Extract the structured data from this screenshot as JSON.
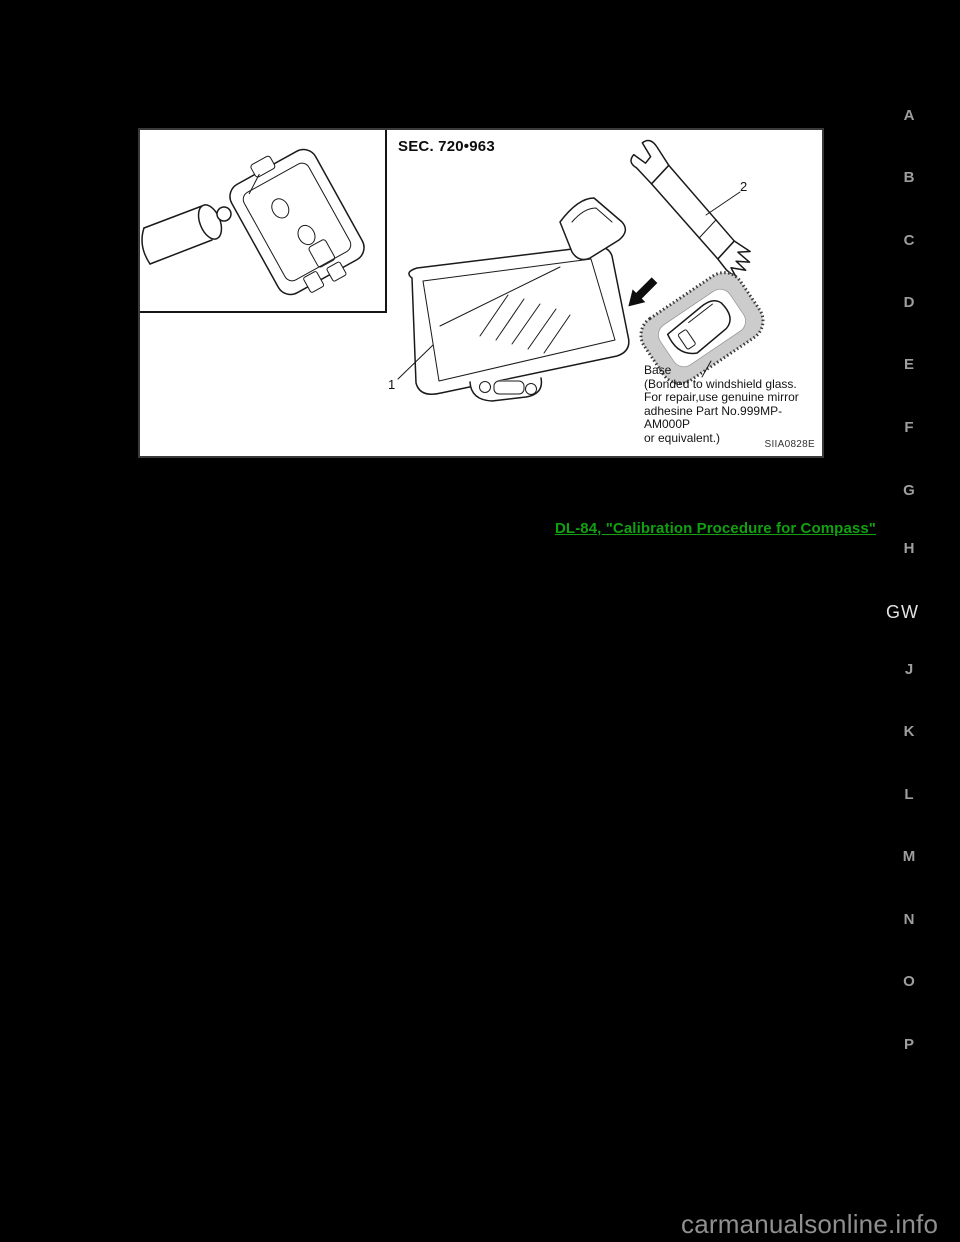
{
  "page": {
    "background": "#000000"
  },
  "diagram": {
    "sec_label": "SEC. 720•963",
    "callout_1": "1",
    "callout_2": "2",
    "base_note_lines": [
      "Base",
      "(Bonded to windshield glass.",
      "For repair,use genuine mirror",
      "adhesine Part No.999MP-AM000P",
      "or equivalent.)"
    ],
    "figure_code": "SIIA0828E"
  },
  "link": {
    "text": "DL-84, \"Calibration Procedure for Compass\""
  },
  "colors": {
    "link_green": "#12A012",
    "tab_gray": "#9e9e9e",
    "current_section_white": "#e2e2e2"
  },
  "section_tabs": {
    "current": "GW",
    "letters": [
      {
        "label": "A",
        "y": 115
      },
      {
        "label": "B",
        "y": 177
      },
      {
        "label": "C",
        "y": 240
      },
      {
        "label": "D",
        "y": 302
      },
      {
        "label": "E",
        "y": 364
      },
      {
        "label": "F",
        "y": 427
      },
      {
        "label": "G",
        "y": 490
      },
      {
        "label": "H",
        "y": 548
      },
      {
        "label": "J",
        "y": 669
      },
      {
        "label": "K",
        "y": 731
      },
      {
        "label": "L",
        "y": 794
      },
      {
        "label": "M",
        "y": 856
      },
      {
        "label": "N",
        "y": 919
      },
      {
        "label": "O",
        "y": 981
      },
      {
        "label": "P",
        "y": 1044
      }
    ]
  },
  "watermark": {
    "text": "carmanualsonline.info"
  }
}
